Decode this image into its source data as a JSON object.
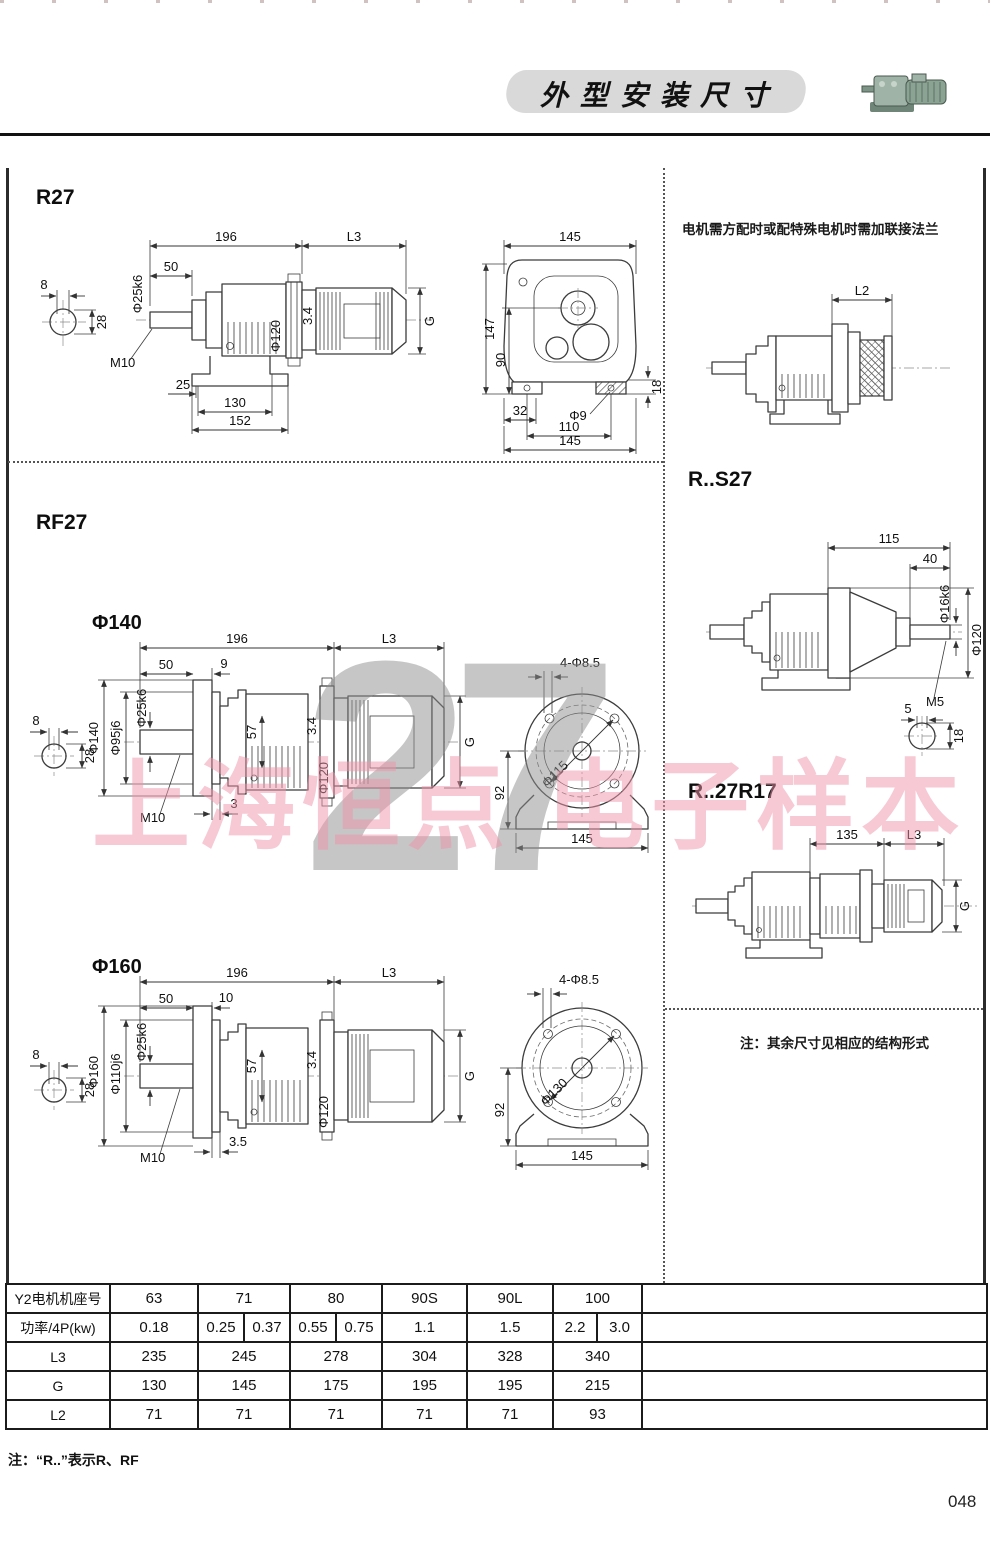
{
  "header": {
    "title": "外型安装尺寸"
  },
  "watermark": {
    "big": "27",
    "pink": "上海恒点 电子样本"
  },
  "top_note_right": "电机需方配时或配特殊电机时需加联接法兰",
  "r27": {
    "title": "R27",
    "side": {
      "len196": "196",
      "lenL3": "L3",
      "len50": "50",
      "shaft_dia": "Φ25k6",
      "key_w": "8",
      "key_h": "28",
      "tap": "M10",
      "flange_dia": "Φ120",
      "gap": "3.4",
      "motor_h": "G",
      "foot25": "25",
      "foot130": "130",
      "foot152": "152"
    },
    "end": {
      "w145": "145",
      "h147": "147",
      "h90": "90",
      "h18": "18",
      "off32": "32",
      "hole": "Φ9",
      "w110": "110",
      "w145b": "145"
    }
  },
  "flange_opt": {
    "lenL2": "L2"
  },
  "rs27": {
    "title": "R..S27",
    "dims": {
      "len115": "115",
      "len40": "40",
      "shaft_dia": "Φ16k6",
      "flange_dia": "Φ120",
      "tap": "M5",
      "key_w": "5",
      "key_h": "18"
    }
  },
  "r27r17": {
    "title": "R..27R17",
    "dims": {
      "len135": "135",
      "lenL3": "L3",
      "motor_h": "G"
    }
  },
  "note_right": "注：其余尺寸见相应的结构形式",
  "rf27": {
    "title": "RF27",
    "f140": {
      "label": "Φ140",
      "side": {
        "len196": "196",
        "lenL3": "L3",
        "len50": "50",
        "th": "9",
        "shaft_dia": "Φ25k6",
        "spigot": "Φ95j6",
        "flange": "Φ140",
        "key_w": "8",
        "key_h": "28",
        "h57": "57",
        "gap": "3.4",
        "ring": "Φ120",
        "tap": "M10",
        "off": "3",
        "motor_h": "G"
      },
      "face": {
        "holes": "4-Φ8.5",
        "bolt_circle": "Φ115",
        "h92": "92",
        "w145": "145"
      }
    },
    "f160": {
      "label": "Φ160",
      "side": {
        "len196": "196",
        "lenL3": "L3",
        "len50": "50",
        "th": "10",
        "shaft_dia": "Φ25k6",
        "spigot": "Φ110j6",
        "flange": "Φ160",
        "key_w": "8",
        "key_h": "28",
        "h57": "57",
        "gap": "3.4",
        "ring": "Φ120",
        "tap": "M10",
        "off": "3.5",
        "motor_h": "G"
      },
      "face": {
        "holes": "4-Φ8.5",
        "bolt_circle": "Φ130",
        "h92": "92",
        "w145": "145"
      }
    }
  },
  "table": {
    "rows": [
      {
        "label": "Y2电机机座号",
        "cells": [
          "63",
          "71",
          "80",
          "90S",
          "90L",
          "100"
        ]
      },
      {
        "label": "功率/4P(kw)",
        "cells": [
          [
            "0.18"
          ],
          [
            "0.25",
            "0.37"
          ],
          [
            "0.55",
            "0.75"
          ],
          [
            "1.1"
          ],
          [
            "1.5"
          ],
          [
            "2.2",
            "3.0"
          ]
        ]
      },
      {
        "label": "L3",
        "cells": [
          "235",
          "245",
          "278",
          "304",
          "328",
          "340"
        ]
      },
      {
        "label": "G",
        "cells": [
          "130",
          "145",
          "175",
          "195",
          "195",
          "215"
        ]
      },
      {
        "label": "L2",
        "cells": [
          "71",
          "71",
          "71",
          "71",
          "71",
          "93"
        ]
      }
    ]
  },
  "footer": {
    "note": "注：“R..”表示R、RF",
    "page": "048"
  }
}
